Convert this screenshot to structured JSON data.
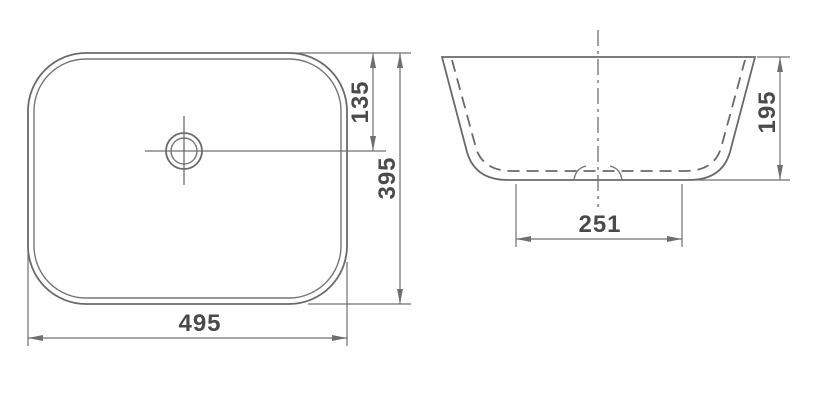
{
  "drawing": {
    "kind": "technical-dimension-drawing",
    "subject": "rectangular countertop wash basin",
    "colors": {
      "line": "#6a6a6a",
      "dimension_line": "#6f6f6f",
      "text": "#4a4a4a",
      "background": "#ffffff"
    },
    "views": {
      "top_view": {
        "name": "plan view",
        "dimensions": {
          "overall_width": "495",
          "overall_depth": "395",
          "drain_offset_from_back": "135"
        }
      },
      "side_view": {
        "name": "front elevation",
        "dimensions": {
          "overall_height": "195",
          "base_width": "251"
        }
      }
    }
  }
}
